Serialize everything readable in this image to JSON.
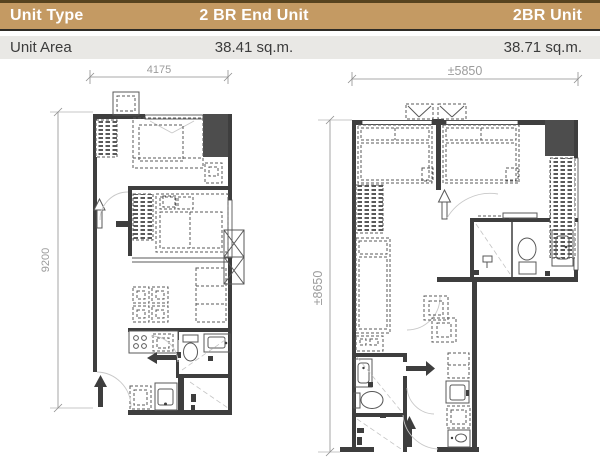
{
  "table": {
    "unit_type_label": "Unit Type",
    "unit_area_label": "Unit Area",
    "left_unit_name": "2 BR End Unit",
    "right_unit_name": "2BR Unit",
    "left_unit_area": "38.41 sq.m.",
    "right_unit_area": "38.71 sq.m."
  },
  "plans": {
    "left": {
      "width_label": "4175",
      "height_label": "9200"
    },
    "right": {
      "width_label": "±5850",
      "height_label": "±8650"
    }
  },
  "colors": {
    "header_bg": "#c49a63",
    "header_text": "#ffffff",
    "row_bg": "#e9e8e5",
    "wall": "#3e3e3e",
    "dim_text": "#9c9c9c"
  }
}
